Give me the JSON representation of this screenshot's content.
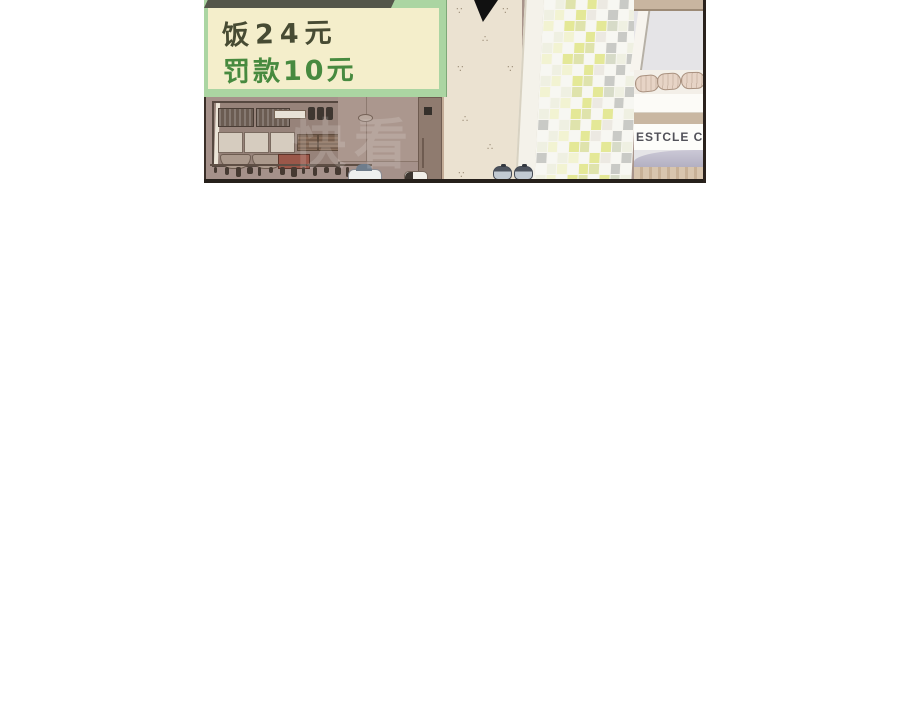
{
  "scene": {
    "type": "comic-panel",
    "watermark": "快看",
    "menu_board": {
      "line1": "饭24元",
      "line2": "罚款10元",
      "line1_color": "#474b33",
      "line2_color": "#478a3f",
      "board_bg": "#f4eecb",
      "border_color": "#abd5a2",
      "top_bar_color": "#54564a"
    },
    "counter_sign": {
      "text": "ESTCLE COU",
      "text_color": "#52525a"
    },
    "wallpaper": {
      "motif_glyph": "∴",
      "bg": "#ebe2d1",
      "motif_color": "#92816c"
    },
    "tiles": {
      "palette": [
        "#f7f7f2",
        "#eff0e2",
        "#e4e897",
        "#c9cac6",
        "#f2f3d2",
        "#dfe3ac",
        "#ece9e2",
        "#d7dbc8"
      ],
      "grout": "#f7f6f0"
    },
    "colors": {
      "kitchen_wall": "#a8948b",
      "panel_border": "#2a221d",
      "counter_band_tan": "#c9b7a2",
      "counter_lavender": "#bfbccd",
      "arrow": "#111111"
    }
  }
}
